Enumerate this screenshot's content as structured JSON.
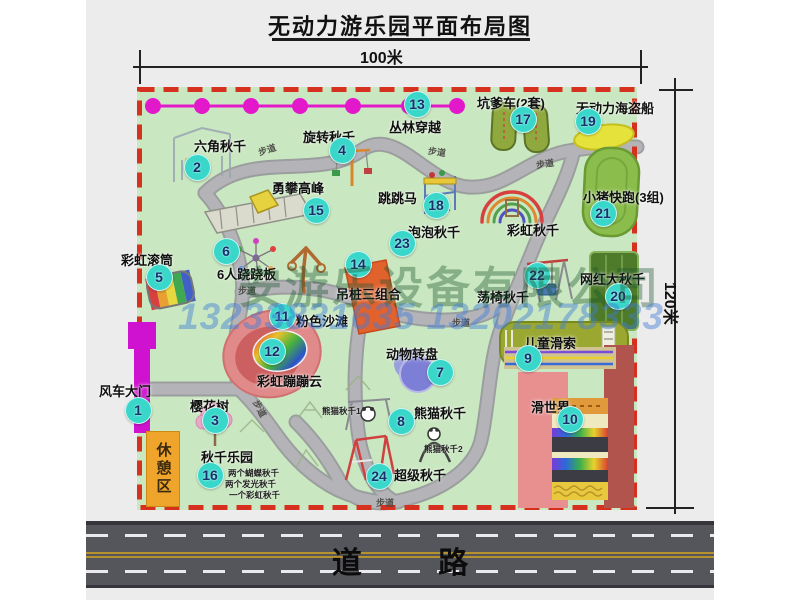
{
  "title": "无动力游乐园平面布局图",
  "dimensions": {
    "width_label": "100米",
    "height_label": "120米"
  },
  "road": {
    "label": "道 路"
  },
  "watermark": {
    "company": "安游乐设备有限公司",
    "phones": "13233831635 13202178333"
  },
  "rest_area": {
    "label": "休憩区"
  },
  "walkway_label": "步道",
  "colors": {
    "park_green": "#c9e7c0",
    "border_red": "#d6301e",
    "path_gray": "#b0b0b4",
    "marker_cyan": "#38d7ca",
    "chain_magenta": "#e318cb",
    "gate_magenta": "#cf12cf",
    "rest_orange": "#efa42c",
    "road_gray": "#55555c",
    "road_yellow": "#b5922e"
  },
  "attractions": [
    {
      "num": "1",
      "name": "风车大门",
      "label": {
        "x": 99,
        "y": 381
      },
      "marker": {
        "x": 138,
        "y": 410
      },
      "icon": "windmill-gate-icon"
    },
    {
      "num": "2",
      "name": "六角秋千",
      "label": {
        "x": 194,
        "y": 136
      },
      "marker": {
        "x": 197,
        "y": 167
      },
      "icon": "swing-frame-icon"
    },
    {
      "num": "3",
      "name": "樱花树",
      "label": {
        "x": 190,
        "y": 396
      },
      "marker": {
        "x": 215,
        "y": 420
      },
      "icon": "cherry-tree-icon"
    },
    {
      "num": "4",
      "name": "旋转秋千",
      "label": {
        "x": 303,
        "y": 127
      },
      "marker": {
        "x": 342,
        "y": 150
      },
      "icon": "rotating-swing-icon"
    },
    {
      "num": "5",
      "name": "彩虹滚筒",
      "label": {
        "x": 121,
        "y": 250
      },
      "marker": {
        "x": 159,
        "y": 277
      },
      "icon": "rainbow-roller-icon"
    },
    {
      "num": "6",
      "name": "6人跷跷板",
      "label": {
        "x": 217,
        "y": 264
      },
      "marker": {
        "x": 226,
        "y": 251
      },
      "icon": "seesaw-icon"
    },
    {
      "num": "7",
      "name": "动物转盘",
      "label": {
        "x": 386,
        "y": 344
      },
      "marker": {
        "x": 440,
        "y": 372
      },
      "icon": "turntable-icon"
    },
    {
      "num": "8",
      "name": "熊猫秋千",
      "label": {
        "x": 414,
        "y": 403
      },
      "marker": {
        "x": 401,
        "y": 421
      },
      "icon": "panda-swing-icon"
    },
    {
      "num": "9",
      "name": "儿童滑索",
      "label": {
        "x": 524,
        "y": 333
      },
      "marker": {
        "x": 528,
        "y": 358
      },
      "icon": "zipline-icon"
    },
    {
      "num": "10",
      "name": "滑世界",
      "label": {
        "x": 531,
        "y": 397
      },
      "marker": {
        "x": 570,
        "y": 419
      },
      "icon": "slide-world-icon"
    },
    {
      "num": "11",
      "name": "粉色沙滩",
      "label": {
        "x": 296,
        "y": 311
      },
      "marker": {
        "x": 282,
        "y": 316
      },
      "icon": "pink-beach-icon"
    },
    {
      "num": "12",
      "name": "彩虹蹦蹦云",
      "label": {
        "x": 257,
        "y": 371
      },
      "marker": {
        "x": 272,
        "y": 351
      },
      "icon": "rainbow-cloud-icon"
    },
    {
      "num": "13",
      "name": "丛林穿越",
      "label": {
        "x": 389,
        "y": 117
      },
      "marker": {
        "x": 417,
        "y": 104
      },
      "icon": "jungle-chain-icon"
    },
    {
      "num": "14",
      "name": "吊桩三组合",
      "label": {
        "x": 336,
        "y": 284
      },
      "marker": {
        "x": 358,
        "y": 264
      },
      "icon": "hanging-pile-icon"
    },
    {
      "num": "15",
      "name": "勇攀高峰",
      "label": {
        "x": 272,
        "y": 178
      },
      "marker": {
        "x": 316,
        "y": 210
      },
      "icon": "climbing-peak-icon"
    },
    {
      "num": "16",
      "name": "秋千乐园",
      "label": {
        "x": 201,
        "y": 447
      },
      "marker": {
        "x": 210,
        "y": 475
      },
      "icon": "swing-park-icon"
    },
    {
      "num": "17",
      "name": "坑爹车(2套)",
      "label": {
        "x": 477,
        "y": 93
      },
      "marker": {
        "x": 523,
        "y": 119
      },
      "icon": "kart-track-icon"
    },
    {
      "num": "18",
      "name": "跳跳马",
      "label": {
        "x": 378,
        "y": 188
      },
      "marker": {
        "x": 436,
        "y": 205
      },
      "icon": "jumping-horse-icon"
    },
    {
      "num": "19",
      "name": "无动力海盗船",
      "label": {
        "x": 576,
        "y": 98
      },
      "marker": {
        "x": 588,
        "y": 121
      },
      "icon": "pirate-ship-icon"
    },
    {
      "num": "20",
      "name": "网红大秋千",
      "label": {
        "x": 580,
        "y": 269
      },
      "marker": {
        "x": 618,
        "y": 296
      },
      "icon": "big-swing-mat-icon"
    },
    {
      "num": "21",
      "name": "小猪快跑(3组)",
      "label": {
        "x": 583,
        "y": 187
      },
      "marker": {
        "x": 603,
        "y": 213
      },
      "icon": "pig-run-track-icon"
    },
    {
      "num": "22",
      "name": "荡椅秋千",
      "label": {
        "x": 477,
        "y": 287
      },
      "marker": {
        "x": 537,
        "y": 275
      },
      "icon": "chair-swing-icon"
    },
    {
      "num": "23",
      "name": "泡泡秋千",
      "label": {
        "x": 408,
        "y": 222
      },
      "marker": {
        "x": 402,
        "y": 243
      },
      "icon": "bubble-swing-icon"
    },
    {
      "num": "24",
      "name": "超级秋千",
      "label": {
        "x": 394,
        "y": 465
      },
      "marker": {
        "x": 379,
        "y": 476
      },
      "icon": "super-swing-icon"
    }
  ],
  "unnumbered_labels": [
    {
      "name": "彩虹秋千",
      "label": {
        "x": 507,
        "y": 220
      },
      "icon": "rainbow-arch-swing-icon"
    }
  ],
  "sub_labels": [
    {
      "text": "熊猫秋千1",
      "x": 322,
      "y": 405
    },
    {
      "text": "熊猫秋千2",
      "x": 424,
      "y": 443
    },
    {
      "text": "两个蝴蝶秋千",
      "x": 228,
      "y": 467
    },
    {
      "text": "两个发光秋千",
      "x": 225,
      "y": 478
    },
    {
      "text": "一个彩虹秋千",
      "x": 229,
      "y": 489
    }
  ],
  "walkway_labels": [
    {
      "x": 258,
      "y": 143,
      "rot": -18
    },
    {
      "x": 428,
      "y": 145,
      "rot": 8
    },
    {
      "x": 536,
      "y": 157,
      "rot": -8
    },
    {
      "x": 238,
      "y": 284,
      "rot": 0
    },
    {
      "x": 452,
      "y": 316,
      "rot": 0
    },
    {
      "x": 376,
      "y": 496,
      "rot": 0
    },
    {
      "x": 251,
      "y": 402,
      "rot": 62
    }
  ]
}
